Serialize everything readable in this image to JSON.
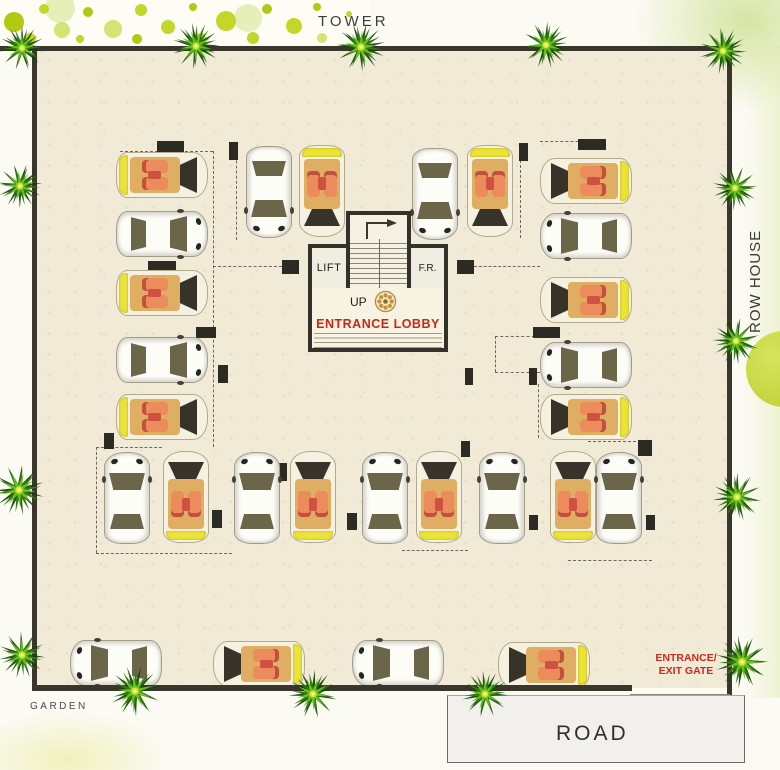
{
  "labels": {
    "tower": "TOWER",
    "row_house": "ROW HOUSE",
    "road": "ROAD",
    "garden": "GARDEN",
    "entrance_gate_line1": "ENTRANCE/",
    "entrance_gate_line2": "EXIT GATE"
  },
  "core": {
    "lift_label": "LIFT",
    "fr_label": "F.R.",
    "up_label": "UP",
    "lobby_label": "ENTRANCE LOBBY"
  },
  "colors": {
    "red_label": "#cc2a1c",
    "wall": "#3a362d",
    "floor": "#f0ead7",
    "palm_dark": "#16430b",
    "palm_mid": "#2f7d12",
    "palm_bright": "#6abf1d",
    "palm_center": "#d3e635",
    "dot_green": "#c3d62a",
    "dot_green_dark": "#b2c914",
    "dot_green_pale": "#e6efb9",
    "dot_green_soft": "#d4e472",
    "car_yellow": "#ebe336",
    "car_tan": "#e0ae62",
    "seat_red": "#ce5142",
    "gold_motif": "#b98f3e"
  },
  "plan": {
    "cars": [
      {
        "x": 116,
        "y": 152,
        "dir": "right",
        "type": "tan"
      },
      {
        "x": 116,
        "y": 211,
        "dir": "right",
        "type": "white"
      },
      {
        "x": 116,
        "y": 270,
        "dir": "right",
        "type": "tan"
      },
      {
        "x": 116,
        "y": 337,
        "dir": "right",
        "type": "white"
      },
      {
        "x": 116,
        "y": 394,
        "dir": "right",
        "type": "tan"
      },
      {
        "x": 246,
        "y": 146,
        "dir": "down",
        "type": "white"
      },
      {
        "x": 299,
        "y": 145,
        "dir": "down",
        "type": "tan"
      },
      {
        "x": 412,
        "y": 148,
        "dir": "down",
        "type": "white"
      },
      {
        "x": 467,
        "y": 145,
        "dir": "down",
        "type": "tan"
      },
      {
        "x": 540,
        "y": 158,
        "dir": "left",
        "type": "tan"
      },
      {
        "x": 540,
        "y": 213,
        "dir": "left",
        "type": "white"
      },
      {
        "x": 540,
        "y": 277,
        "dir": "left",
        "type": "tan"
      },
      {
        "x": 540,
        "y": 342,
        "dir": "left",
        "type": "white"
      },
      {
        "x": 540,
        "y": 394,
        "dir": "left",
        "type": "tan"
      },
      {
        "x": 104,
        "y": 452,
        "dir": "up",
        "type": "white"
      },
      {
        "x": 163,
        "y": 451,
        "dir": "up",
        "type": "tan"
      },
      {
        "x": 234,
        "y": 452,
        "dir": "up",
        "type": "white"
      },
      {
        "x": 290,
        "y": 451,
        "dir": "up",
        "type": "tan"
      },
      {
        "x": 362,
        "y": 452,
        "dir": "up",
        "type": "white"
      },
      {
        "x": 416,
        "y": 451,
        "dir": "up",
        "type": "tan"
      },
      {
        "x": 479,
        "y": 452,
        "dir": "up",
        "type": "white"
      },
      {
        "x": 550,
        "y": 451,
        "dir": "up",
        "type": "tan"
      },
      {
        "x": 596,
        "y": 452,
        "dir": "up",
        "type": "white"
      },
      {
        "x": 70,
        "y": 640,
        "dir": "left",
        "type": "white"
      },
      {
        "x": 213,
        "y": 641,
        "dir": "left",
        "type": "tan"
      },
      {
        "x": 352,
        "y": 640,
        "dir": "left",
        "type": "white"
      },
      {
        "x": 498,
        "y": 642,
        "dir": "left",
        "type": "tan"
      }
    ],
    "palms": [
      {
        "x": 22,
        "y": 48,
        "s": 46
      },
      {
        "x": 196,
        "y": 46,
        "s": 48
      },
      {
        "x": 361,
        "y": 47,
        "s": 50
      },
      {
        "x": 546,
        "y": 45,
        "s": 48
      },
      {
        "x": 723,
        "y": 51,
        "s": 48
      },
      {
        "x": 20,
        "y": 186,
        "s": 46
      },
      {
        "x": 19,
        "y": 490,
        "s": 52
      },
      {
        "x": 22,
        "y": 655,
        "s": 48
      },
      {
        "x": 735,
        "y": 188,
        "s": 46
      },
      {
        "x": 736,
        "y": 341,
        "s": 48
      },
      {
        "x": 737,
        "y": 497,
        "s": 50
      },
      {
        "x": 742,
        "y": 662,
        "s": 54
      },
      {
        "x": 135,
        "y": 691,
        "s": 52
      },
      {
        "x": 313,
        "y": 694,
        "s": 50
      },
      {
        "x": 485,
        "y": 694,
        "s": 48
      }
    ],
    "pillars": [
      [
        157,
        141,
        27,
        11
      ],
      [
        148,
        261,
        28,
        11
      ],
      [
        196,
        327,
        20,
        11
      ],
      [
        218,
        365,
        10,
        18
      ],
      [
        104,
        433,
        10,
        16
      ],
      [
        229,
        142,
        9,
        18
      ],
      [
        519,
        143,
        9,
        18
      ],
      [
        578,
        139,
        28,
        11
      ],
      [
        533,
        327,
        27,
        11
      ],
      [
        465,
        368,
        8,
        17
      ],
      [
        529,
        368,
        8,
        17
      ],
      [
        277,
        463,
        10,
        18
      ],
      [
        212,
        510,
        10,
        18
      ],
      [
        347,
        513,
        10,
        17
      ],
      [
        461,
        441,
        9,
        16
      ],
      [
        638,
        440,
        14,
        16
      ],
      [
        529,
        515,
        9,
        15
      ],
      [
        646,
        515,
        9,
        15
      ],
      [
        282,
        260,
        17,
        14
      ],
      [
        457,
        260,
        17,
        14
      ]
    ],
    "dashes": [
      [
        120,
        151,
        213,
        151
      ],
      [
        213,
        151,
        213,
        447
      ],
      [
        213,
        266,
        282,
        266
      ],
      [
        474,
        266,
        540,
        266
      ],
      [
        96,
        447,
        162,
        447
      ],
      [
        96,
        447,
        96,
        553
      ],
      [
        96,
        553,
        232,
        553
      ],
      [
        236,
        145,
        236,
        240
      ],
      [
        520,
        160,
        520,
        238
      ],
      [
        540,
        141,
        604,
        141
      ],
      [
        495,
        336,
        540,
        336
      ],
      [
        495,
        336,
        495,
        372
      ],
      [
        495,
        372,
        540,
        372
      ],
      [
        538,
        384,
        538,
        438
      ],
      [
        588,
        441,
        651,
        441
      ],
      [
        402,
        550,
        468,
        550
      ],
      [
        568,
        560,
        652,
        560
      ]
    ],
    "dots": [
      [
        60,
        8,
        15,
        "p3"
      ],
      [
        248,
        18,
        14,
        "p3"
      ],
      [
        14,
        22,
        10,
        "p2"
      ],
      [
        44,
        9,
        5,
        "p1"
      ],
      [
        30,
        39,
        6,
        "p1"
      ],
      [
        62,
        30,
        8,
        "p4"
      ],
      [
        88,
        12,
        5,
        "p2"
      ],
      [
        80,
        39,
        4,
        "p1"
      ],
      [
        113,
        29,
        9,
        "p4"
      ],
      [
        141,
        10,
        6,
        "p1"
      ],
      [
        137,
        39,
        5,
        "p2"
      ],
      [
        168,
        27,
        7,
        "p1"
      ],
      [
        193,
        7,
        4,
        "p2"
      ],
      [
        201,
        38,
        5,
        "p1"
      ],
      [
        226,
        21,
        10,
        "p1"
      ],
      [
        253,
        38,
        6,
        "p1"
      ],
      [
        267,
        9,
        5,
        "p2"
      ],
      [
        294,
        26,
        8,
        "p1"
      ],
      [
        317,
        7,
        4,
        "p2"
      ],
      [
        322,
        38,
        5,
        "p4"
      ],
      [
        349,
        14,
        3,
        "p1"
      ]
    ]
  }
}
